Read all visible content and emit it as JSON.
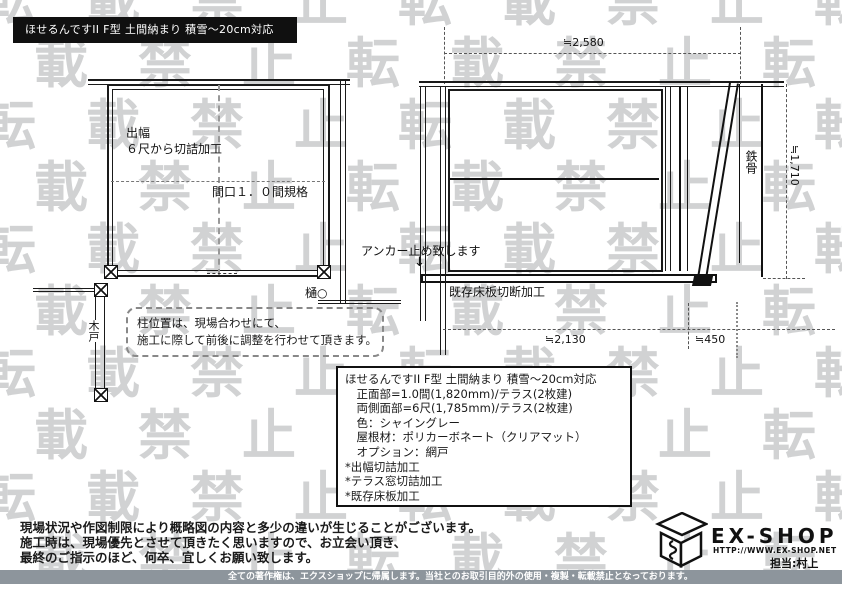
{
  "page": {
    "bg": "#ffffff",
    "line_color": "#1a1a1a"
  },
  "watermark": {
    "text": "転載禁止",
    "color": "#c9cbcc",
    "rows": 10,
    "repeat_per_row": 3,
    "row_start": -26,
    "row_step": 62,
    "offset_even": -18,
    "offset_odd": -70
  },
  "title_bar": {
    "text": "ほせるんですII F型 土間納まり 積雪～20cm対応",
    "bg": "#101010",
    "fg": "#ffffff"
  },
  "plan_view": {
    "depth_label_line1": "出幅",
    "depth_label_line2": "６尺から切詰加工",
    "width_label": "間口１．０間規格",
    "gutter_label": "樋○",
    "gate_label": "木戸",
    "note_line1": "柱位置は、現場合わせにて、",
    "note_line2": "施工に際して前後に調整を行わせて頂きます。"
  },
  "elevation_view": {
    "dim_top": "≒2,580",
    "dim_right": "≒1,710",
    "dim_bottom_main": "≒2,130",
    "dim_bottom_sub": "≒450",
    "steel_label": "鉄骨",
    "anchor_label": "アンカー止め致します",
    "anchor_arrow": "↓",
    "floor_cut_label": "既存床板切断加工"
  },
  "spec_box": {
    "lines": [
      "ほせるんですII F型 土間納まり 積雪～20cm対応",
      "　正面部=1.0間(1,820mm)/テラス(2枚建)",
      "　両側面部=6尺(1,785mm)/テラス(2枚建)",
      "　色：シャイングレー",
      "　屋根材：ポリカーボネート（クリアマット）",
      "　オプション：網戸",
      "*出幅切詰加工",
      "*テラス窓切詰加工",
      "*既存床板加工"
    ]
  },
  "notes": {
    "lines": [
      "現場状況や作図制限により概略図の内容と多少の違いが生じることがございます。",
      "施工時は、現場優先とさせて頂きたく思いますので、お立会い頂き、",
      "最終のご指示のほど、何卒、宜しくお願い致します。"
    ]
  },
  "footer": {
    "bar_text": "全ての著作権は、エクスショップに帰属します。当社とのお取引目的外の使用・複製・転載禁止となっております。",
    "bar_bg": "#8d959c"
  },
  "logo": {
    "name": "EX-SHOP",
    "url": "HTTP://WWW.EX-SHOP.NET",
    "contact": "担当:村上"
  }
}
